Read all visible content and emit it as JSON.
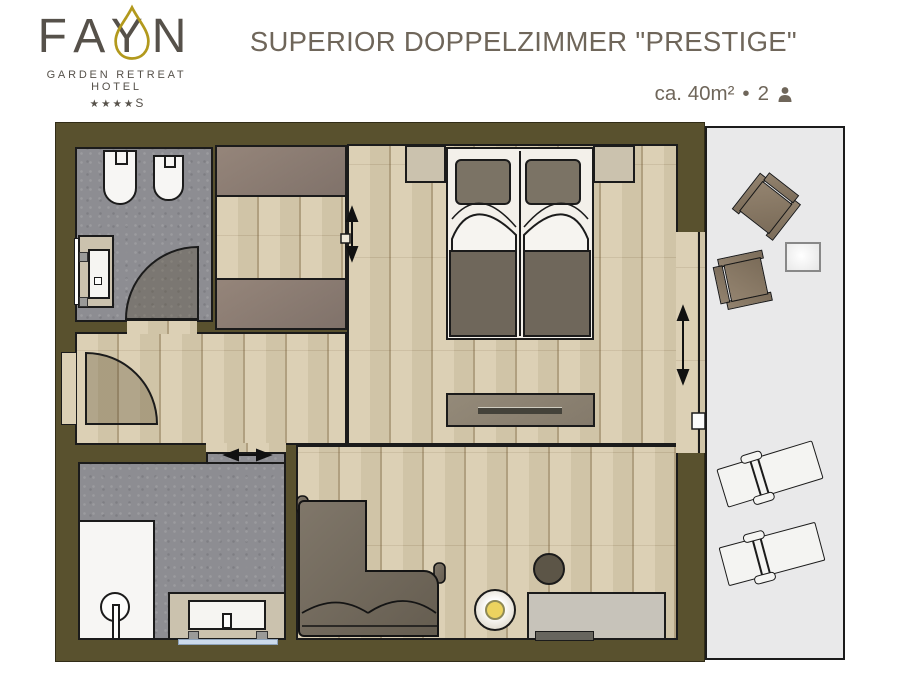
{
  "logo": {
    "brand": "FAYN",
    "tagline": "GARDEN RETREAT HOTEL",
    "stars": "★★★★",
    "stars_suffix": "S"
  },
  "header": {
    "title": "SUPERIOR DOPPELZIMMER \"PRESTIGE\"",
    "area": "ca. 40m²",
    "separator": "•",
    "capacity": "2"
  },
  "colors": {
    "wall": "#59512e",
    "wood": "#d8cbad",
    "tile": "#8d8d92",
    "balcony": "#e9e9ea",
    "gold": "#b2991d",
    "text": "#6f665a",
    "logo_text": "#56514a",
    "furniture_brown": "#8a7a6b",
    "bed_blanket": "#6f675b",
    "accent_yellow": "#ecd35f"
  }
}
